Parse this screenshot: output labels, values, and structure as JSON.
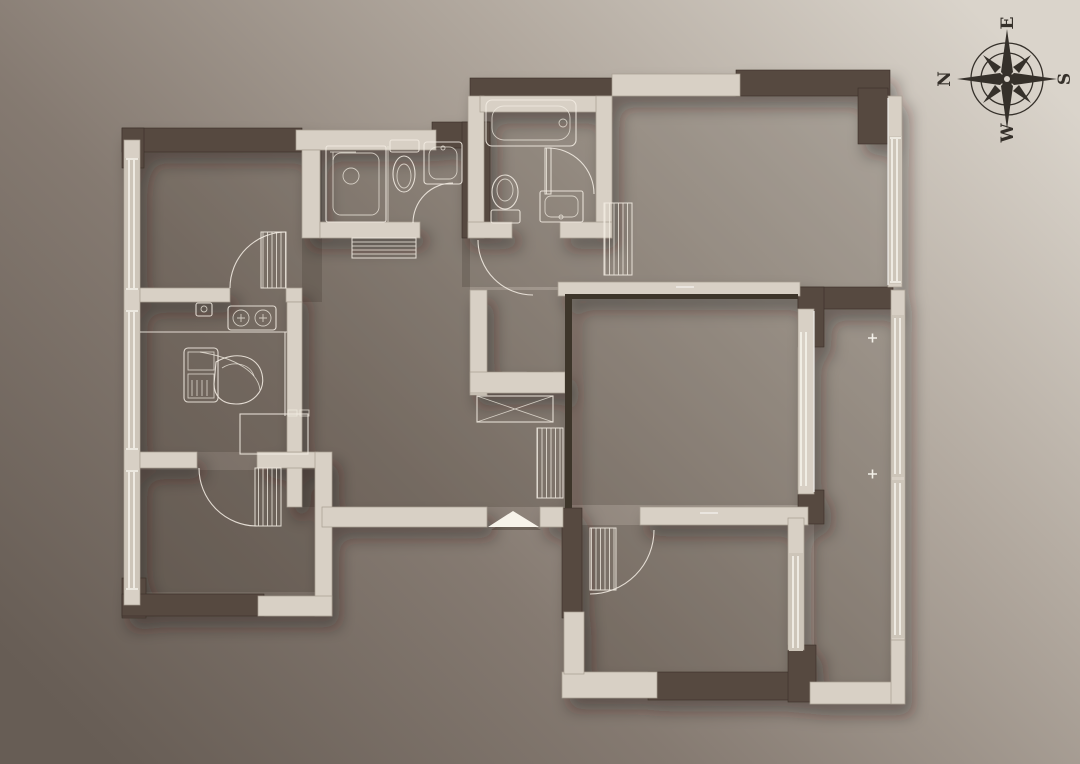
{
  "compass": {
    "north": "N",
    "east": "E",
    "south": "S",
    "west": "W"
  },
  "palette": {
    "bg_dark": "#675d55",
    "bg_mid1": "#857a71",
    "bg_mid2": "#b3aaa0",
    "bg_light": "#dad4cb",
    "wall_dark": "#574a40",
    "wall_edge": "#3e342c",
    "wall_light": "#d8d0c5",
    "floor_shade": "rgba(56,46,38,0.22)",
    "line": "#f2ece2",
    "entry_white": "#f7f3ea",
    "compass_ink": "#35302a"
  }
}
